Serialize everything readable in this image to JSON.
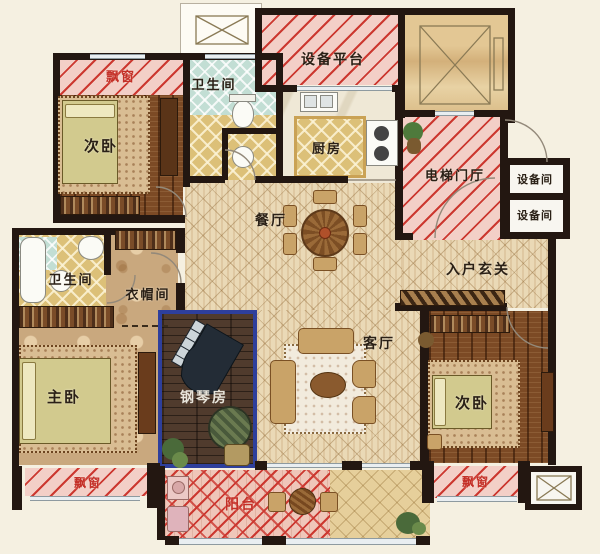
{
  "rooms": {
    "bay_window_top_left": {
      "label": "飘窗"
    },
    "bedroom_top_left": {
      "label": "次卧"
    },
    "bathroom_top": {
      "label": "卫生间"
    },
    "equipment_platform": {
      "label": "设备平台"
    },
    "kitchen": {
      "label": "厨房"
    },
    "elevator_lobby": {
      "label": "电梯门厅"
    },
    "equipment_room_upper": {
      "label": "设备间"
    },
    "equipment_room_lower": {
      "label": "设备间"
    },
    "dining_room": {
      "label": "餐厅"
    },
    "entry_foyer": {
      "label": "入户玄关"
    },
    "bathroom_left": {
      "label": "卫生间"
    },
    "cloakroom": {
      "label": "衣帽间"
    },
    "master_bedroom": {
      "label": "主卧"
    },
    "piano_room": {
      "label": "钢琴房"
    },
    "living_room": {
      "label": "客厅"
    },
    "bedroom_bottom_right": {
      "label": "次卧"
    },
    "bay_window_bottom_left": {
      "label": "飘窗"
    },
    "balcony": {
      "label": "阳台"
    },
    "bay_window_bottom_right": {
      "label": "飘窗"
    }
  },
  "colors": {
    "wall": "#231711",
    "stripe_red": "#cc3830",
    "bay_pink": "#f3cfc7",
    "wood_floor": "#7c4a25",
    "piano_room_wood": "#503b2d",
    "piano_room_border": "#2e3f9c",
    "parquet": "#ead9b6",
    "gold_tile": "#dcc078",
    "teal_tile": "#c2ded4",
    "bedroom_tan": "#c9a87e",
    "background": "#f5f0e1",
    "label_dark": "#2a2016",
    "label_red": "#c43028",
    "label_white": "#e8e4da"
  }
}
